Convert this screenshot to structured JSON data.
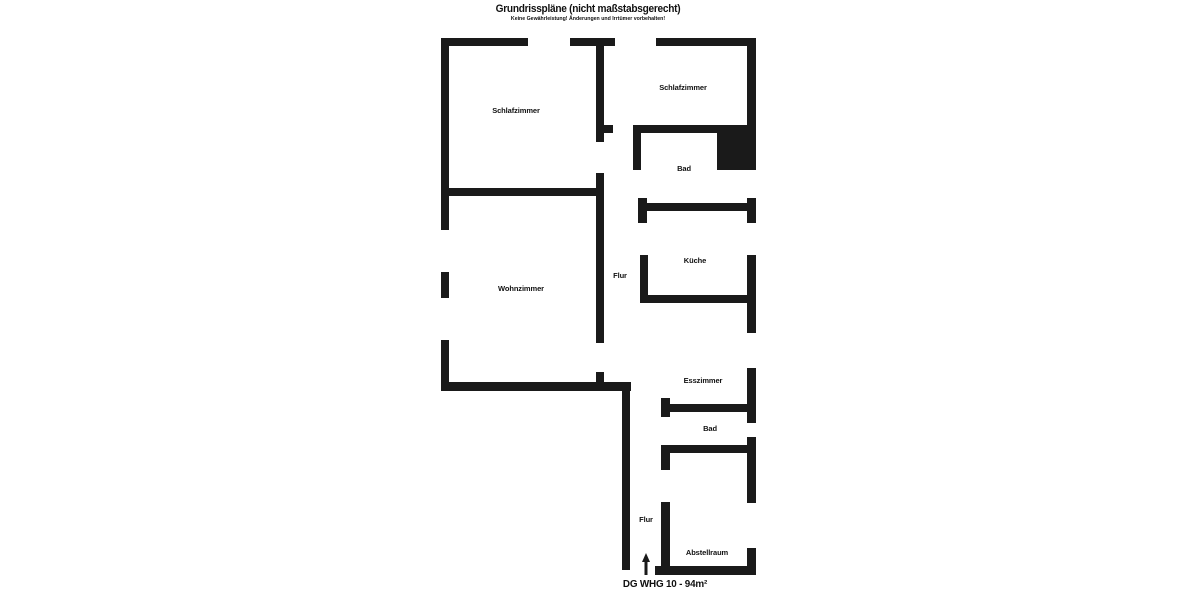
{
  "header": {
    "title": "Grundrisspläne (nicht maßstabsgerecht)",
    "subtitle": "Keine Gewährleistung! Änderungen und Irrtümer vorbehalten!"
  },
  "caption": "DG WHG 10 - 94m²",
  "colors": {
    "wall": "#1a1a1a",
    "background": "#ffffff",
    "text": "#111111"
  },
  "floorplan": {
    "rooms": [
      {
        "id": "schlafzimmer-left",
        "label": "Schlafzimmer",
        "x": 516,
        "y": 111
      },
      {
        "id": "schlafzimmer-right",
        "label": "Schlafzimmer",
        "x": 683,
        "y": 88
      },
      {
        "id": "bad-upper",
        "label": "Bad",
        "x": 684,
        "y": 169
      },
      {
        "id": "kueche",
        "label": "Küche",
        "x": 695,
        "y": 261
      },
      {
        "id": "flur-upper",
        "label": "Flur",
        "x": 620,
        "y": 276
      },
      {
        "id": "wohnzimmer",
        "label": "Wohnzimmer",
        "x": 521,
        "y": 289
      },
      {
        "id": "esszimmer",
        "label": "Esszimmer",
        "x": 703,
        "y": 381
      },
      {
        "id": "bad-lower",
        "label": "Bad",
        "x": 710,
        "y": 429
      },
      {
        "id": "flur-lower",
        "label": "Flur",
        "x": 646,
        "y": 520
      },
      {
        "id": "abstellraum",
        "label": "Abstellraum",
        "x": 707,
        "y": 553
      }
    ],
    "walls": [
      [
        441,
        38,
        87,
        8
      ],
      [
        570,
        38,
        45,
        8
      ],
      [
        656,
        38,
        100,
        8
      ],
      [
        441,
        46,
        8,
        184
      ],
      [
        441,
        272,
        8,
        26
      ],
      [
        441,
        340,
        8,
        50
      ],
      [
        747,
        46,
        9,
        124
      ],
      [
        747,
        198,
        9,
        25
      ],
      [
        747,
        255,
        9,
        78
      ],
      [
        747,
        368,
        9,
        55
      ],
      [
        747,
        437,
        9,
        66
      ],
      [
        747,
        548,
        9,
        27
      ],
      [
        655,
        566,
        101,
        9
      ],
      [
        596,
        46,
        8,
        96
      ],
      [
        604,
        125,
        9,
        8
      ],
      [
        596,
        173,
        8,
        170
      ],
      [
        448,
        188,
        148,
        8
      ],
      [
        596,
        372,
        8,
        10
      ],
      [
        441,
        382,
        190,
        9
      ],
      [
        622,
        391,
        8,
        179
      ],
      [
        633,
        125,
        123,
        8
      ],
      [
        633,
        133,
        8,
        37
      ],
      [
        638,
        198,
        9,
        25
      ],
      [
        638,
        203,
        109,
        8
      ],
      [
        640,
        255,
        8,
        48
      ],
      [
        648,
        295,
        99,
        8
      ],
      [
        661,
        398,
        9,
        19
      ],
      [
        661,
        404,
        86,
        8
      ],
      [
        661,
        445,
        9,
        25
      ],
      [
        661,
        445,
        87,
        8
      ],
      [
        661,
        502,
        9,
        73
      ]
    ],
    "shaft": {
      "x": 717,
      "y": 133,
      "w": 39,
      "h": 37
    },
    "entrance_arrow": {
      "x": 646,
      "y_tip": 553,
      "y_base": 575
    }
  }
}
